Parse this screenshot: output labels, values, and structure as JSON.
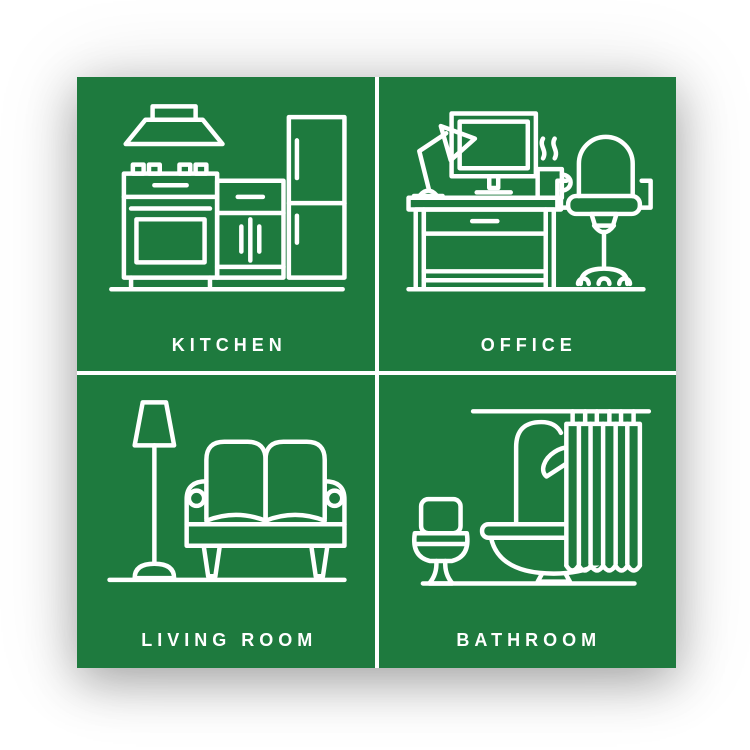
{
  "poster": {
    "rooms": [
      {
        "label": "KITCHEN",
        "icon": "kitchen-icon"
      },
      {
        "label": "OFFICE",
        "icon": "office-icon"
      },
      {
        "label": "LIVING ROOM",
        "icon": "living-room-icon"
      },
      {
        "label": "BATHROOM",
        "icon": "bathroom-icon"
      }
    ]
  },
  "colors": {
    "poster_green": "#1e7a3e",
    "line_white": "#ffffff",
    "page_background": "#ffffff"
  }
}
